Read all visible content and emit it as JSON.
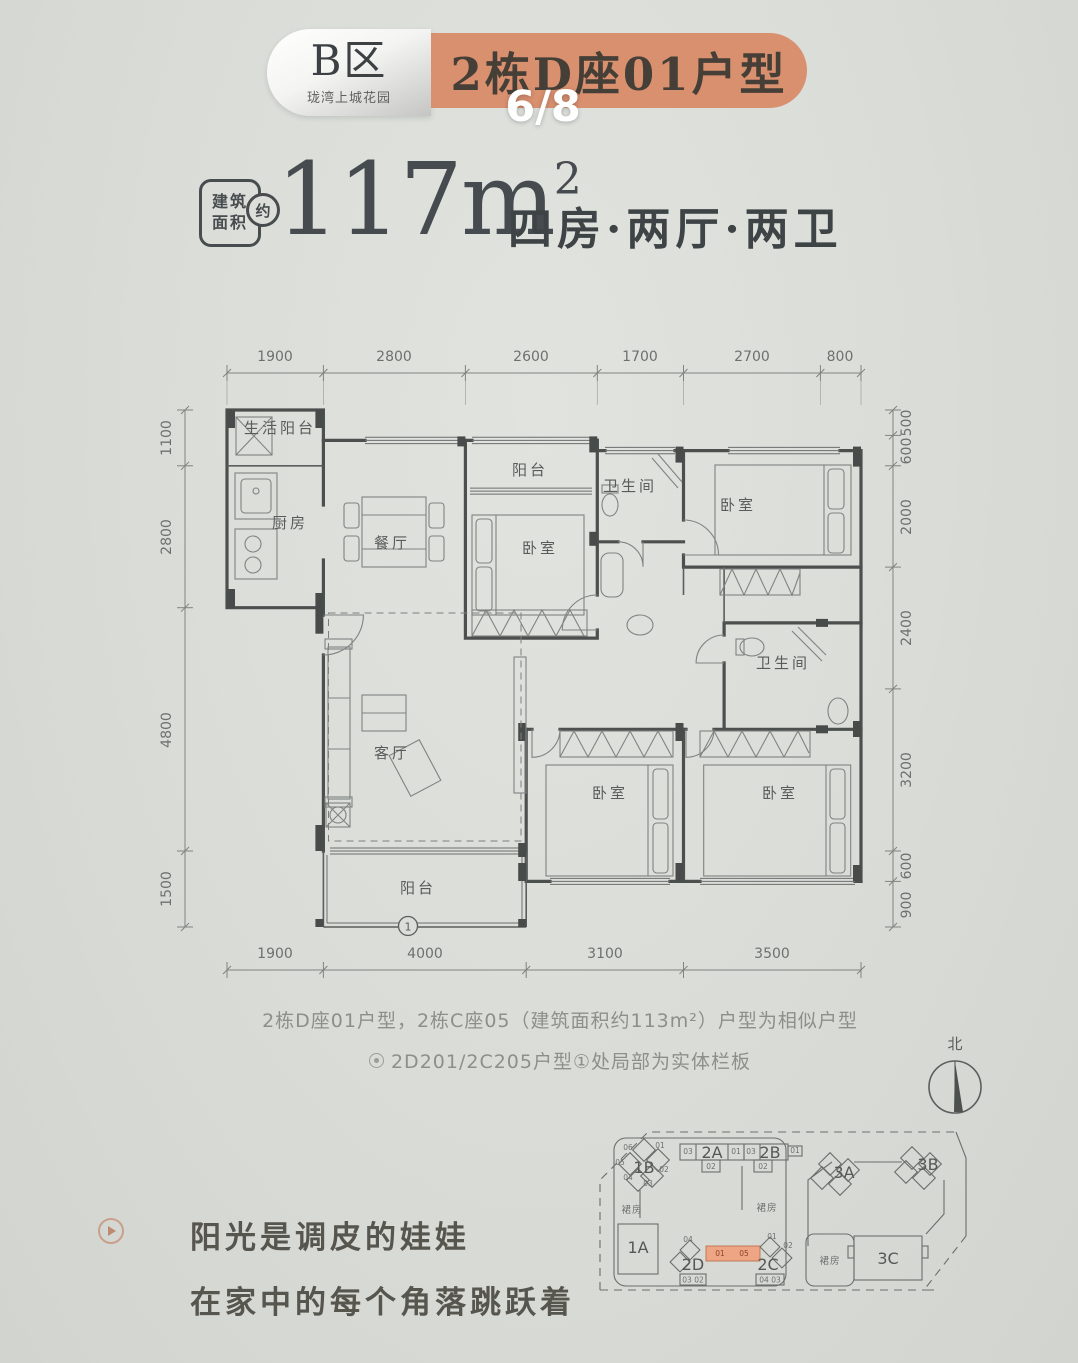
{
  "header": {
    "zone": "B区",
    "zone_subtitle": "珑湾上城花园",
    "title": "2栋D座01户型",
    "page": "6/8"
  },
  "summary": {
    "badge_line1": "建筑",
    "badge_line2": "面积",
    "badge_approx": "约",
    "area": "117m",
    "area_exp": "2",
    "rooms_text": "四房·两厅·两卫"
  },
  "plan": {
    "dims_top": [
      "1900",
      "2800",
      "2600",
      "1700",
      "2700",
      "800"
    ],
    "dims_left": [
      "1100",
      "2800",
      "4800",
      "1500"
    ],
    "dims_right": [
      "500",
      "600",
      "2000",
      "2400",
      "3200",
      "600",
      "900"
    ],
    "dims_bottom": [
      "1900",
      "4000",
      "3100",
      "3500"
    ],
    "rooms": {
      "service_balcony": "生活阳台",
      "kitchen": "厨房",
      "dining": "餐厅",
      "balcony_top": "阳台",
      "bedroom_a": "卧室",
      "bath_a": "卫生间",
      "bedroom_b": "卧室",
      "bath_b": "卫生间",
      "living": "客厅",
      "balcony_bottom": "阳台",
      "bedroom_c": "卧室",
      "bedroom_d": "卧室"
    },
    "balcony_marker": "1"
  },
  "notes": {
    "line1": "2栋D座01户型，2栋C座05（建筑面积约113m²）户型为相似户型",
    "line2": "2D201/2C205户型①处局部为实体栏板"
  },
  "compass": {
    "north": "北"
  },
  "siteplan": {
    "b1a": "1A",
    "b1b": "1B",
    "b2a": "2A",
    "b2b": "2B",
    "b2c": "2C",
    "b2d": "2D",
    "b3a": "3A",
    "b3b": "3B",
    "b3c": "3C",
    "podium1": "裙房",
    "podium2": "裙房",
    "podium3": "裙房",
    "n1b": [
      "06",
      "01",
      "05",
      "02",
      "04",
      "03"
    ],
    "n2a": [
      "03",
      "01",
      "02"
    ],
    "n2b": [
      "03",
      "01",
      "02"
    ],
    "n2d": [
      "04",
      "03",
      "02"
    ],
    "n2c": [
      "01",
      "02",
      "04",
      "03"
    ],
    "highlight": [
      "01",
      "05"
    ]
  },
  "tagline": {
    "line1": "阳光是调皮的娃娃",
    "line2": "在家中的每个角落跳跃着"
  },
  "colors": {
    "accent_orange": "#d9906f",
    "background": "#dcdeda",
    "ink": "#45494b",
    "site_highlight": "#eda584"
  }
}
